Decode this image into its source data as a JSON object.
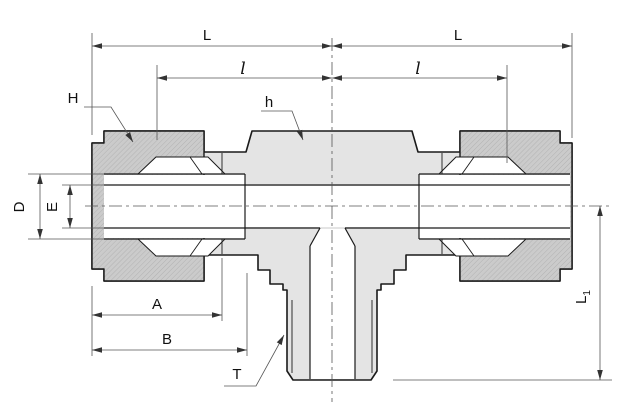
{
  "drawing": {
    "labels": {
      "dim_L_left": "L",
      "dim_L_right": "L",
      "dim_l_left": "l",
      "dim_l_right": "l",
      "dim_H": "H",
      "dim_h": "h",
      "dim_D": "D",
      "dim_E": "E",
      "dim_A": "A",
      "dim_B": "B",
      "dim_T": "T",
      "dim_L1": {
        "main": "L",
        "sub": "1"
      }
    },
    "colors": {
      "background": "#ffffff",
      "body_fill": "#e4e4e4",
      "nut_fill": "#cbcbcb",
      "outline": "#1a1a1a",
      "dim_color": "#555555",
      "text": "#111111"
    }
  }
}
